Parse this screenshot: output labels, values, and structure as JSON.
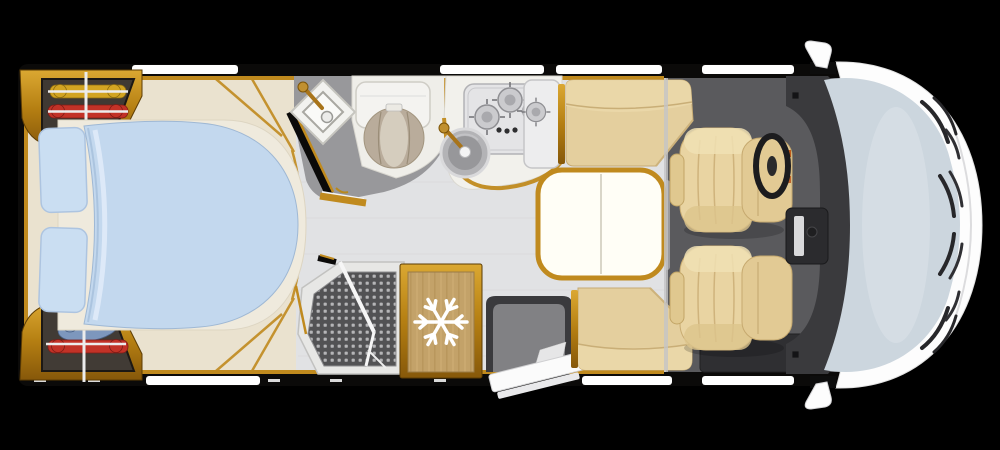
{
  "scene": {
    "title": "motorhome-floorplan-top-view",
    "canvas": {
      "width": 1000,
      "height": 450
    },
    "background": "#000000",
    "orientation": "cab-on-right"
  },
  "colors": {
    "bg": "#000000",
    "wall": "#0b0a09",
    "gold": "#c08a1e",
    "gold_dark": "#8a5c08",
    "floor_bedroom": "#eae2cf",
    "floor_living": "#e1e2e4",
    "floor_bath": "#98989b",
    "floor_cab": "#5a5a5d",
    "duvet": "#c3d8ee",
    "pillow": "#cadef2",
    "beige": "#e4cf9e",
    "dash": "#3a3a3d",
    "windshield": "#ccd6de",
    "window": "#ffffff",
    "body_white": "#fdfdfd",
    "fridge_wood": "#c3a269",
    "cloth_yellow": "#d2a422",
    "cloth_red": "#c23227",
    "cloth_blue": "#7d97bd",
    "table_top": "#fffef6"
  },
  "counts": {
    "hob_burners": 3,
    "cab_seats": 2,
    "dinette_benches": 2,
    "wardrobes": 2,
    "wardrobe_garments": 4,
    "wing_mirrors": 2
  },
  "icons": [
    {
      "name": "snowflake-icon",
      "meaning": "refrigerator"
    }
  ],
  "zones": {
    "bedroom": {
      "fixtures": [
        "wardrobe-top",
        "wardrobe-bottom",
        "island-bed",
        "pillows",
        "duvet",
        "hanging-rails"
      ]
    },
    "bathroom": {
      "fixtures": [
        "washbasin",
        "washbasin-faucet",
        "toilet",
        "bathroom-door"
      ]
    },
    "kitchen": {
      "fixtures": [
        "gas-hob-3-burner",
        "hob-knobs",
        "round-sink",
        "kitchen-faucet",
        "side-cabinet"
      ]
    },
    "shower": {
      "fixtures": [
        "shower-tray",
        "folding-shower-door"
      ]
    },
    "refrigerator": {
      "fixtures": [
        "fridge-cabinet",
        "snowflake-icon"
      ]
    },
    "entrance": {
      "fixtures": [
        "entry-step-mat",
        "entry-door-open"
      ]
    },
    "dinette": {
      "fixtures": [
        "bench-rear",
        "table",
        "bench-front"
      ]
    },
    "cab": {
      "fixtures": [
        "driver-seat",
        "passenger-seat",
        "steering-wheel",
        "dashboard",
        "center-console",
        "cab-step"
      ]
    },
    "exterior": {
      "fixtures": [
        "hood",
        "windshield",
        "wiper-blades",
        "wing-mirror-top",
        "wing-mirror-bottom",
        "wall-windows"
      ]
    }
  }
}
